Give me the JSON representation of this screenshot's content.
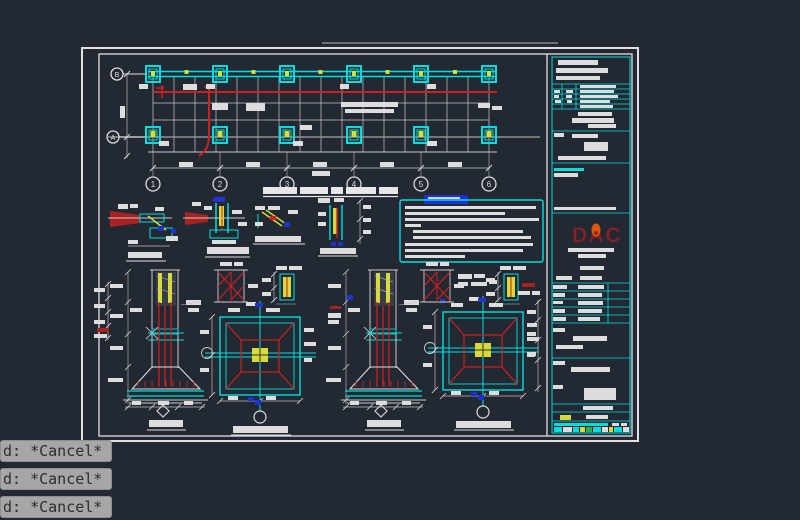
{
  "app": {
    "canvas_bg": "#232933",
    "type": "cad-model-space"
  },
  "command_history": {
    "entries": [
      {
        "text": "d: *Cancel*"
      },
      {
        "text": "d: *Cancel*"
      },
      {
        "text": "d: *Cancel*"
      }
    ]
  },
  "drawing": {
    "plan": {
      "axes_bottom": [
        "1",
        "2",
        "3",
        "4",
        "5",
        "6"
      ],
      "axes_left": [
        "B",
        "A"
      ]
    },
    "title_block": {
      "logo": "DAC"
    },
    "colors": {
      "line_white": "#e2e2e2",
      "cyan": "#00dede",
      "red": "#cf2020",
      "yellow": "#d8da3a",
      "blue": "#2233cc",
      "gray": "#8f8f8f",
      "logo_red": "#7c2430",
      "logo_flame": "#e0560f",
      "command_bar_bg": "#a6a6a6",
      "command_text": "#2d2d2d"
    }
  }
}
